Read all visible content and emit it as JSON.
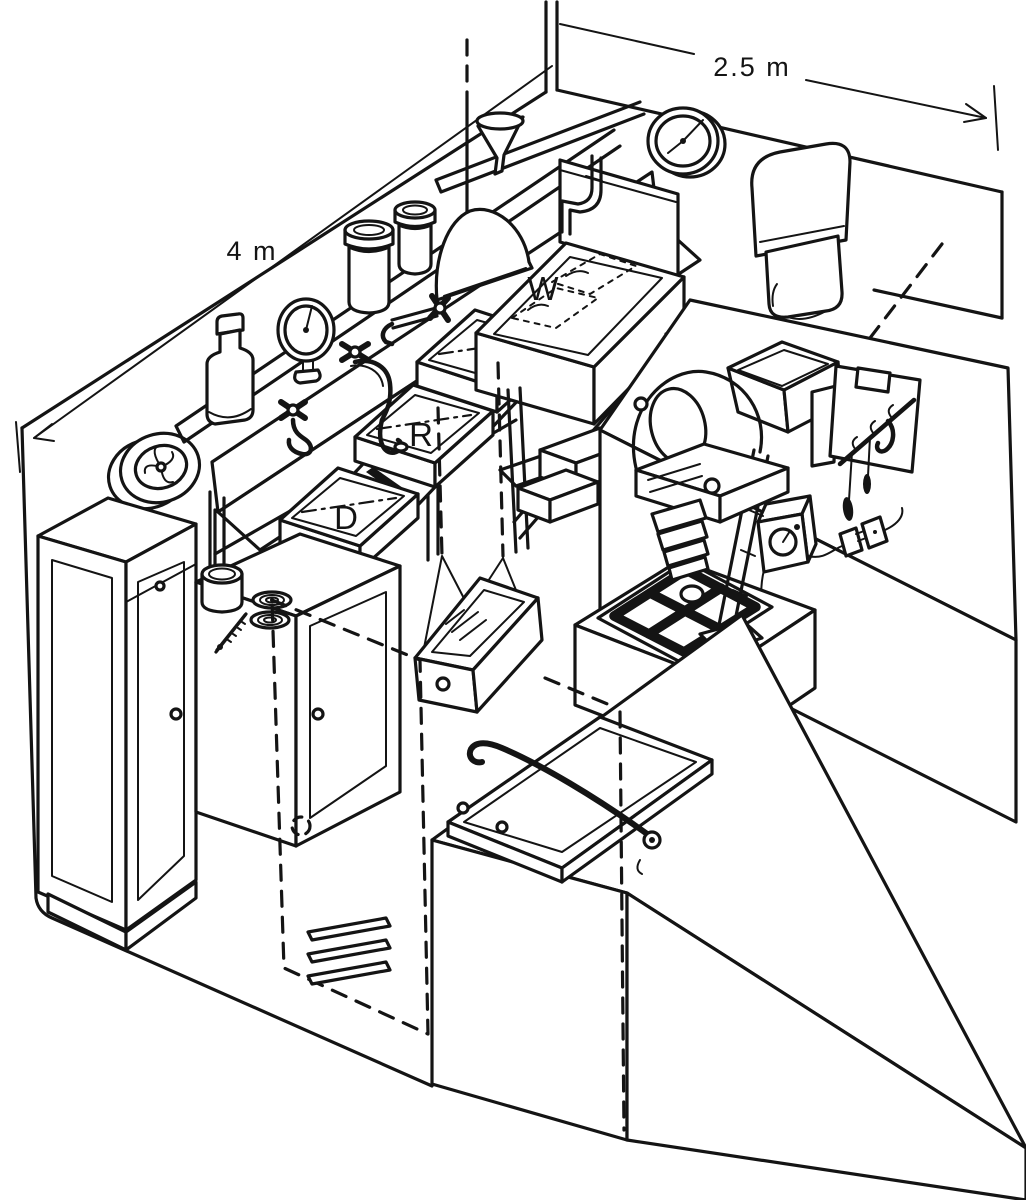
{
  "diagram": {
    "background_color": "#ffffff",
    "line_color": "#141414",
    "dimensions": {
      "length_label": "4 m",
      "width_label": "2.5 m"
    },
    "sink_labels": {
      "developer": "D",
      "rinse": "R",
      "fixer": "F",
      "wash": "W"
    },
    "equipment_icons": [
      "extractor-fan-icon",
      "storage-bottle-icon",
      "process-timer-clock-icon",
      "chemical-jar-icon",
      "funnel-icon",
      "hanging-safelight-dome-icon",
      "wall-clock-icon",
      "paper-towel-dispenser-icon",
      "tap-icon",
      "developer-tray-icon",
      "rinse-tray-icon",
      "fixer-tray-icon",
      "wash-sink-icon",
      "duckboard-slats-icon",
      "waste-bin-icon",
      "clipboard-icon",
      "print-tongs-icon",
      "enlarger-timer-icon",
      "power-plug-icon",
      "enlarger-icon",
      "masking-easel-icon",
      "hanging-safelight-box-icon",
      "paper-trimmer-icon",
      "tall-cupboard-icon",
      "low-cupboard-icon",
      "developing-tank-icon",
      "film-reel-icon",
      "thermometer-icon",
      "door-outline-icon",
      "louver-vent-icon"
    ]
  }
}
